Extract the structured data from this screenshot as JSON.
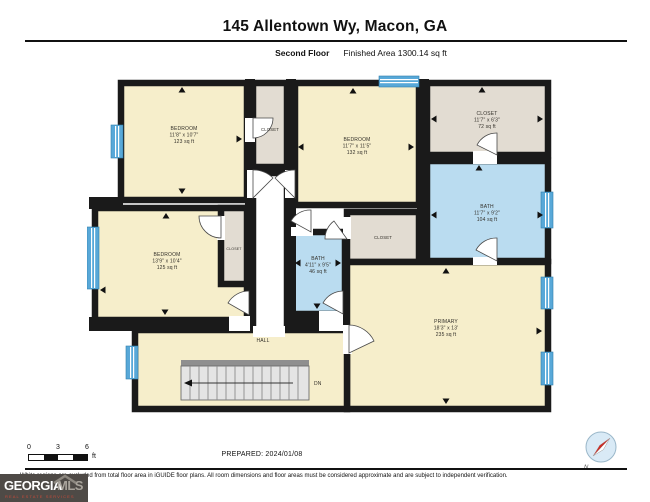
{
  "header": {
    "title": "145 Allentown Wy, Macon, GA",
    "floor_label": "Second Floor",
    "area_label": "Finished Area 1300.14 sq ft"
  },
  "rooms": {
    "bedroom_top_left": {
      "name": "BEDROOM",
      "dims": "11'8\" x 10'7\"",
      "area": "123 sq ft"
    },
    "bedroom_top_mid": {
      "name": "BEDROOM",
      "dims": "11'7\" x 11'5\"",
      "area": "132 sq ft"
    },
    "closet_top_right": {
      "name": "CLOSET",
      "dims": "11'7\" x 6'3\"",
      "area": "72 sq ft"
    },
    "bath_right": {
      "name": "BATH",
      "dims": "11'7\" x 9'2\"",
      "area": "104 sq ft"
    },
    "bedroom_left": {
      "name": "BEDROOM",
      "dims": "13'9\" x 10'4\"",
      "area": "125 sq ft"
    },
    "bath_center": {
      "name": "BATH",
      "dims": "4'11\" x 9'5\"",
      "area": "46 sq ft"
    },
    "primary": {
      "name": "PRIMARY",
      "dims": "18'3\" x 13'",
      "area": "235 sq ft"
    },
    "closet_hall_top": {
      "name": "CLOSET"
    },
    "closet_bedroom_left": {
      "name": "CLOSET"
    },
    "closet_center": {
      "name": "CLOSET"
    },
    "hall": {
      "name": "HALL"
    },
    "stairs": {
      "label": "DN"
    }
  },
  "footer": {
    "scale": {
      "tick0": "0",
      "tick3": "3",
      "tick6": "6",
      "unit": "ft"
    },
    "prepared": "PREPARED: 2024/01/08",
    "compass_n": "N",
    "disclaimer": "White regions are excluded from total floor area in iGUIDE floor plans. All room dimensions and floor areas must be considered approximate and are subject to independent verification."
  },
  "logo": {
    "georgia": "GEORGIA",
    "mls": "MLS",
    "tagline": "REAL ESTATE SERVICES"
  },
  "colors": {
    "wall": "#1a1a1a",
    "room_fill": "#f6eecb",
    "closet_fill": "#e2dcd2",
    "bath_fill": "#badcf0",
    "window_blue": "#58a8d8",
    "excluded_white": "#ffffff",
    "logo_bg": "#4e4a46",
    "logo_tagline_red": "#c84a3a"
  }
}
